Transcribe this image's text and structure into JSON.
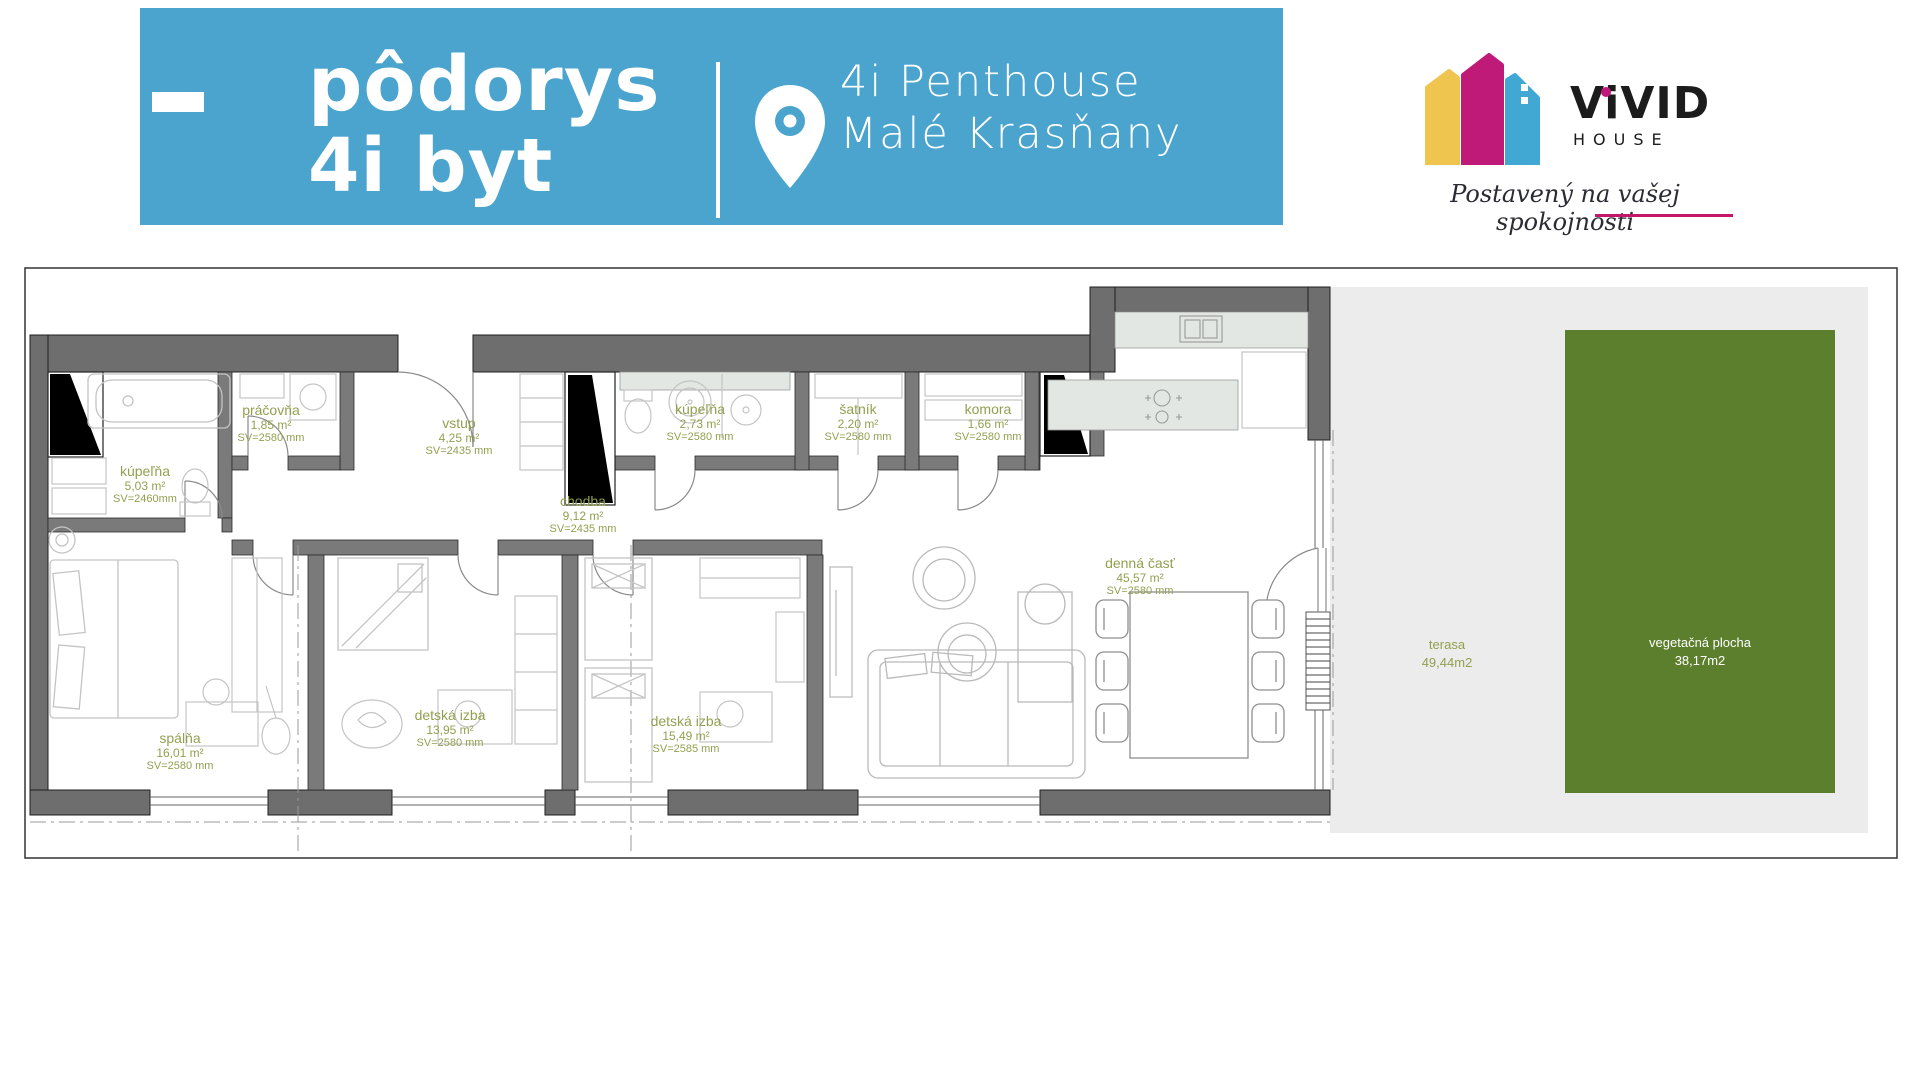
{
  "header": {
    "bg_color": "#4BA4CD",
    "title_line1": "pôdorys",
    "title_line2": "4i byt",
    "location_line1": "4i Penthouse",
    "location_line2": "Malé Krasňany"
  },
  "logo": {
    "brand": "ViVID",
    "brand_sub": "HOUSE",
    "tagline": "Postavený na vašej spokojnosti",
    "colors": {
      "yellow": "#F0C54F",
      "magenta": "#C01A78",
      "blue": "#41A8D4",
      "underline": "#C2186B"
    }
  },
  "floor_plan": {
    "label_color": "#939F4F",
    "terrace_color": "#ECECEC",
    "green_color": "#5C7F2E",
    "wall_color": "#6E6E6E",
    "rooms": [
      {
        "name": "kúpeľňa",
        "area": "5,03 m²",
        "height": "SV=2460mm"
      },
      {
        "name": "práčovňa",
        "area": "1,85 m²",
        "height": "SV=2580 mm"
      },
      {
        "name": "vstup",
        "area": "4,25 m²",
        "height": "SV=2435 mm"
      },
      {
        "name": "kúpeľňa",
        "area": "2,73 m²",
        "height": "SV=2580 mm"
      },
      {
        "name": "šatník",
        "area": "2,20 m²",
        "height": "SV=2580 mm"
      },
      {
        "name": "komora",
        "area": "1,66 m²",
        "height": "SV=2580 mm"
      },
      {
        "name": "chodba",
        "area": "9,12 m²",
        "height": "SV=2435 mm"
      },
      {
        "name": "denná časť",
        "area": "45,57 m²",
        "height": "SV=2580 mm"
      },
      {
        "name": "spálňa",
        "area": "16,01 m²",
        "height": "SV=2580 mm"
      },
      {
        "name": "detská izba",
        "area": "13,95 m²",
        "height": "SV=2580 mm"
      },
      {
        "name": "detská izba",
        "area": "15,49 m²",
        "height": "SV=2585 mm"
      }
    ],
    "outdoor": {
      "terrace": {
        "name": "terasa",
        "area": "49,44m2"
      },
      "green": {
        "name": "vegetačná plocha",
        "area": "38,17m2"
      }
    }
  }
}
